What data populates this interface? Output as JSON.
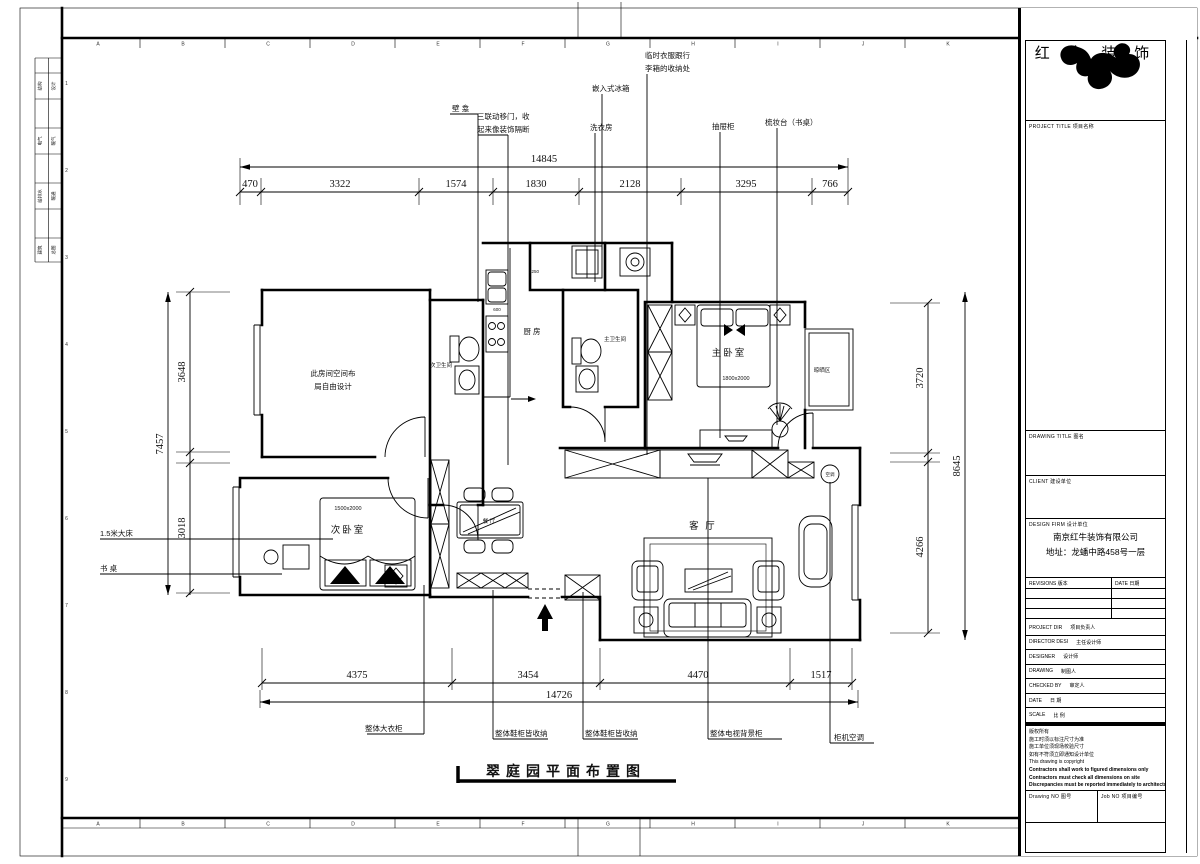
{
  "frame": {
    "grid_letters": [
      "A",
      "B",
      "C",
      "D",
      "E",
      "F",
      "G",
      "H",
      "I",
      "J",
      "K"
    ],
    "row_numbers": [
      "1",
      "2",
      "3",
      "4",
      "5",
      "6",
      "7",
      "8",
      "9"
    ],
    "margin_labels": [
      "结构",
      "设计",
      "电气",
      "暖气",
      "给排水",
      "暖通",
      "建筑",
      "总图"
    ]
  },
  "plan": {
    "title": "翠庭园平面布置图",
    "rooms": {
      "free_room_line1": "此房间空间布",
      "free_room_line2": "局自由设计",
      "secondary_bedroom": "次卧室",
      "secondary_bed_size": "1500x2000",
      "master_bedroom": "主卧室",
      "master_bed_size": "1800x2000",
      "kitchen": "厨 房",
      "secondary_bath": "次卫生间",
      "master_bath": "主卫生间",
      "living_room": "客 厅",
      "dining": "餐 厅",
      "drying_area": "晾晒区",
      "ac_symbol": "空调",
      "counter_600": "600",
      "counter_1250": "1250"
    },
    "annotations": {
      "top": [
        {
          "label": "壁 龛"
        },
        {
          "line1": "三联动移门，收",
          "line2": "起来像装饰隔断"
        },
        {
          "label": "洗衣房"
        },
        {
          "label": "嵌入式冰箱"
        },
        {
          "line1": "临时衣服跟行",
          "line2": "李箱的收纳处"
        },
        {
          "label": "抽屉柜"
        },
        {
          "label": "梳妆台（书桌）"
        }
      ],
      "left": [
        {
          "label": "1.5米大床"
        },
        {
          "label": "书 桌"
        }
      ],
      "bottom": [
        {
          "label": "整体大衣柜"
        },
        {
          "label": "整体鞋柜皆收纳"
        },
        {
          "label": "整体鞋柜皆收纳"
        },
        {
          "label": "整体电视背景柜"
        },
        {
          "label": "柜机空调"
        }
      ]
    },
    "dims": {
      "top_total": "14845",
      "top": [
        "470",
        "3322",
        "1574",
        "1830",
        "2128",
        "3295",
        "766"
      ],
      "left_total": "7457",
      "left": [
        "3648",
        "3018"
      ],
      "right_total": "8645",
      "right": [
        "3720",
        "4266"
      ],
      "bottom_total": "14726",
      "bottom": [
        "4375",
        "3454",
        "4470",
        "1517"
      ]
    }
  },
  "title_block": {
    "company": "红 牛 装 饰",
    "project_title_label": "PROJECT TITLE  项目名称",
    "drawing_title_label": "DRAWING TITLE  图名",
    "client_label": "CLIENT  建设单位",
    "design_firm_label": "DESIGN FIRM  设计单位",
    "design_firm_name": "南京红牛装饰有限公司",
    "design_firm_address": "地址：龙蟠中路458号一层",
    "revisions_label": "REVISIONS  版本",
    "date_col_label": "DATE  日期",
    "rows": [
      {
        "en": "PROJECT DIR",
        "zh": "项目负责人"
      },
      {
        "en": "DIRECTOR DESI",
        "zh": "主任设计师"
      },
      {
        "en": "DESIGNER",
        "zh": "设计师"
      },
      {
        "en": "DRAWING",
        "zh": "制图人"
      },
      {
        "en": "CHECKED BY",
        "zh": "审定人"
      },
      {
        "en": "DATE",
        "zh": "日  期"
      },
      {
        "en": "SCALE",
        "zh": "比  例"
      }
    ],
    "copyright": [
      "版权所有",
      "施工时须以标注尺寸为准",
      "施工单位须现场校验尺寸",
      "如有不符须立即通知设计单位",
      "This drawing is copyright",
      "Contractors shall work to figured dimensions only",
      "Contractors must check all dimensions on site",
      "Discrepancies must be reported immediately to architects"
    ],
    "drawing_no_label": "Drawing NO  图号",
    "job_no_label": "Job NO  项目编号"
  }
}
